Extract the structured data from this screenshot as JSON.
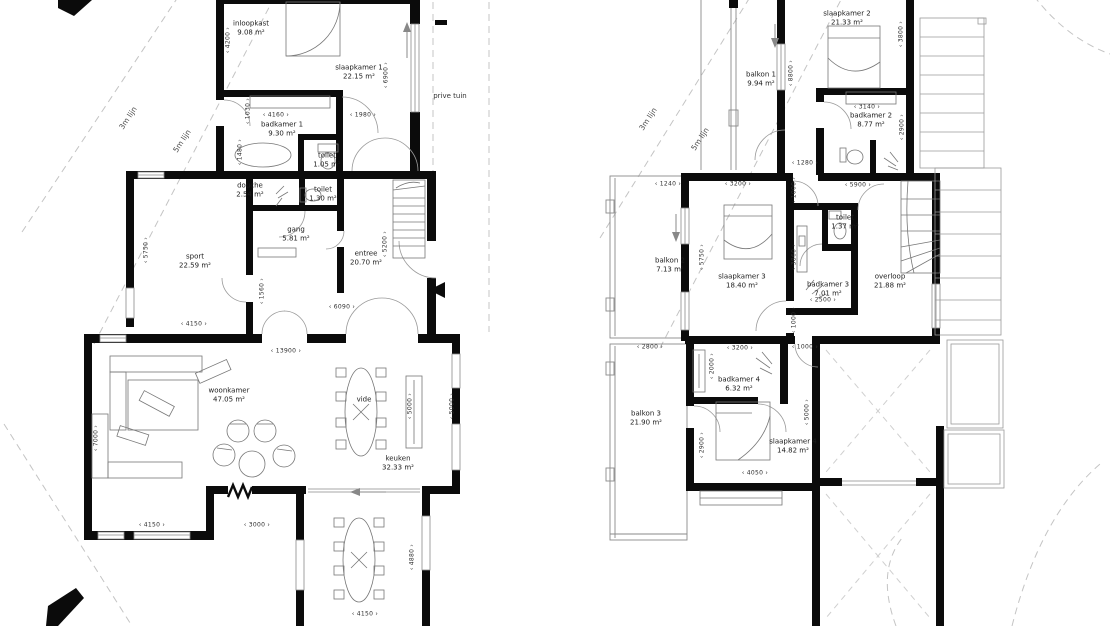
{
  "drawing": {
    "type": "architectural floor plan, two storeys side by side",
    "language": "Dutch",
    "colors": {
      "wall": "#0b0b0b",
      "thin_line": "#777777",
      "site_dash": "#c4c4c4",
      "text": "#1c1c1c"
    },
    "floors": [
      {
        "id": "ground-floor",
        "rooms": [
          {
            "label": "inloopkast",
            "area": "9.08 m²",
            "x": 251,
            "y": 29
          },
          {
            "label": "slaapkamer 1",
            "area": "22.15 m²",
            "x": 359,
            "y": 73
          },
          {
            "label": "badkamer 1",
            "area": "9.30 m²",
            "x": 282,
            "y": 130
          },
          {
            "label": "toilet",
            "area": "1.05 m²",
            "x": 327,
            "y": 161
          },
          {
            "label": "douche",
            "area": "2.54 m²",
            "x": 250,
            "y": 191
          },
          {
            "label": "toilet",
            "area": "1.30 m²",
            "x": 323,
            "y": 195
          },
          {
            "label": "gang",
            "area": "5.81 m²",
            "x": 296,
            "y": 235
          },
          {
            "label": "sport",
            "area": "22.59 m²",
            "x": 195,
            "y": 262
          },
          {
            "label": "entree",
            "area": "20.70 m²",
            "x": 366,
            "y": 259
          },
          {
            "label": "woonkamer",
            "area": "47.05 m²",
            "x": 229,
            "y": 396
          },
          {
            "label": "vide",
            "area": "",
            "x": 364,
            "y": 400
          },
          {
            "label": "keuken",
            "area": "32.33 m²",
            "x": 398,
            "y": 464
          }
        ],
        "dimensions": [
          {
            "text": "4200",
            "x": 228,
            "y": 40,
            "v": true
          },
          {
            "text": "1030",
            "x": 248,
            "y": 111,
            "v": true
          },
          {
            "text": "4160",
            "x": 276,
            "y": 115
          },
          {
            "text": "1980",
            "x": 363,
            "y": 115
          },
          {
            "text": "6900",
            "x": 386,
            "y": 75,
            "v": true
          },
          {
            "text": "1480",
            "x": 240,
            "y": 152,
            "v": true
          },
          {
            "text": "5750",
            "x": 146,
            "y": 250,
            "v": true
          },
          {
            "text": "5200",
            "x": 385,
            "y": 244,
            "v": true
          },
          {
            "text": "1560",
            "x": 262,
            "y": 291,
            "v": true
          },
          {
            "text": "6090",
            "x": 342,
            "y": 307
          },
          {
            "text": "4150",
            "x": 194,
            "y": 324
          },
          {
            "text": "13900",
            "x": 286,
            "y": 351
          },
          {
            "text": "7000",
            "x": 96,
            "y": 438,
            "v": true
          },
          {
            "text": "5000",
            "x": 410,
            "y": 406,
            "v": true
          },
          {
            "text": "5000",
            "x": 452,
            "y": 406,
            "v": true
          },
          {
            "text": "4150",
            "x": 152,
            "y": 525
          },
          {
            "text": "3000",
            "x": 257,
            "y": 525
          },
          {
            "text": "4880",
            "x": 412,
            "y": 557,
            "v": true
          },
          {
            "text": "4150",
            "x": 365,
            "y": 614
          }
        ],
        "annotations": [
          {
            "text": "prive tuin",
            "x": 450,
            "y": 96,
            "rotate": 0,
            "kind": "anno"
          },
          {
            "text": "3m lijn",
            "x": 128,
            "y": 118,
            "rotate": -56,
            "kind": "site"
          },
          {
            "text": "5m lijn",
            "x": 182,
            "y": 141,
            "rotate": -56,
            "kind": "site"
          }
        ]
      },
      {
        "id": "first-floor",
        "rooms": [
          {
            "label": "slaapkamer 2",
            "area": "21.33 m²",
            "x": 847,
            "y": 19
          },
          {
            "label": "balkon 1",
            "area": "9.94 m²",
            "x": 761,
            "y": 80
          },
          {
            "label": "badkamer 2",
            "area": "8.77 m²",
            "x": 871,
            "y": 121
          },
          {
            "label": "toilet",
            "area": "1.37 m²",
            "x": 845,
            "y": 223
          },
          {
            "label": "balkon 2",
            "area": "7.13 m²",
            "x": 670,
            "y": 266
          },
          {
            "label": "slaapkamer 3",
            "area": "18.40 m²",
            "x": 742,
            "y": 282
          },
          {
            "label": "badkamer 3",
            "area": "7.01 m²",
            "x": 828,
            "y": 290
          },
          {
            "label": "overloop",
            "area": "21.88 m²",
            "x": 890,
            "y": 282
          },
          {
            "label": "badkamer 4",
            "area": "6.32 m²",
            "x": 739,
            "y": 385
          },
          {
            "label": "balkon 3",
            "area": "21.90 m²",
            "x": 646,
            "y": 419
          },
          {
            "label": "slaapkamer 4",
            "area": "14.82 m²",
            "x": 793,
            "y": 447
          }
        ],
        "dimensions": [
          {
            "text": "3800",
            "x": 901,
            "y": 34,
            "v": true
          },
          {
            "text": "8800",
            "x": 791,
            "y": 73,
            "v": true
          },
          {
            "text": "3140",
            "x": 867,
            "y": 107
          },
          {
            "text": "2900",
            "x": 902,
            "y": 127,
            "v": true
          },
          {
            "text": "1280",
            "x": 805,
            "y": 163
          },
          {
            "text": "1240",
            "x": 668,
            "y": 184
          },
          {
            "text": "3200",
            "x": 738,
            "y": 184
          },
          {
            "text": "5900",
            "x": 858,
            "y": 185
          },
          {
            "text": "1000",
            "x": 794,
            "y": 190,
            "v": true
          },
          {
            "text": "5750",
            "x": 702,
            "y": 257,
            "v": true
          },
          {
            "text": "3860",
            "x": 794,
            "y": 257,
            "v": true
          },
          {
            "text": "2500",
            "x": 823,
            "y": 300
          },
          {
            "text": "1000",
            "x": 794,
            "y": 320,
            "v": true
          },
          {
            "text": "2800",
            "x": 650,
            "y": 347
          },
          {
            "text": "3200",
            "x": 740,
            "y": 348
          },
          {
            "text": "1000",
            "x": 805,
            "y": 347
          },
          {
            "text": "2000",
            "x": 712,
            "y": 366,
            "v": true
          },
          {
            "text": "5000",
            "x": 807,
            "y": 412,
            "v": true
          },
          {
            "text": "2900",
            "x": 702,
            "y": 445,
            "v": true
          },
          {
            "text": "4050",
            "x": 755,
            "y": 473
          }
        ],
        "annotations": [
          {
            "text": "3m lijn",
            "x": 648,
            "y": 119,
            "rotate": -56,
            "kind": "site"
          },
          {
            "text": "5m lijn",
            "x": 700,
            "y": 139,
            "rotate": -56,
            "kind": "site"
          }
        ]
      }
    ]
  }
}
